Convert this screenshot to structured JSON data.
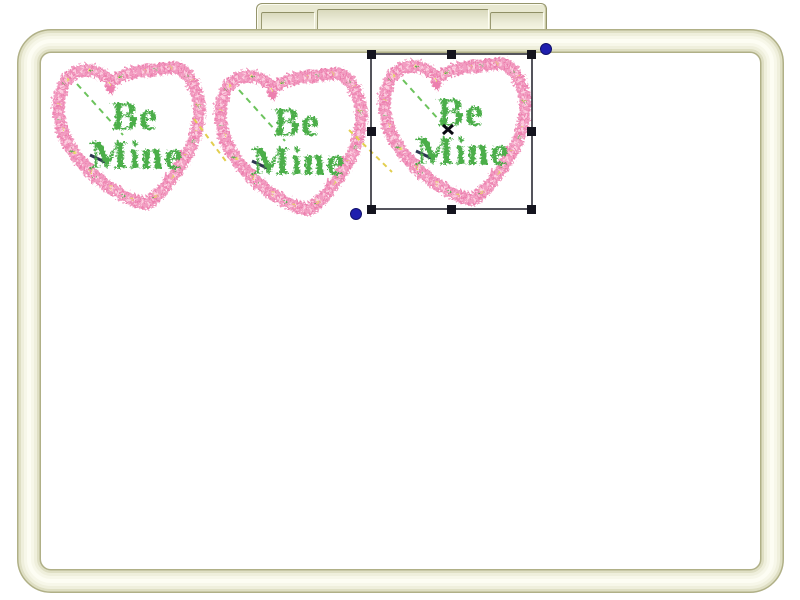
{
  "design_text": {
    "line1": "Be",
    "line2": "Mine"
  },
  "designs": [
    {
      "name": "be-mine-heart-1",
      "selected": false
    },
    {
      "name": "be-mine-heart-2",
      "selected": false
    },
    {
      "name": "be-mine-heart-3",
      "selected": true
    }
  ],
  "selection": {
    "handle_count": 8,
    "rotation_dot_count": 2,
    "center_mark": "x"
  },
  "colors": {
    "heart_stitch_pink": "#f29ec2",
    "heart_stitch_pink_dark": "#ec7fae",
    "heart_stitch_pink_light": "#fccfe0",
    "lettering_green": "#4bae49",
    "jump_stitch_green": "#6cc35c",
    "connector_yellow": "#e2ce4f",
    "tieoff_gold": "#e3da5c",
    "hoop_cream": "#efefdc",
    "hoop_edge_olive": "#b0b087",
    "selection_outline": "#2a2a33",
    "selection_handle": "#14141e",
    "rotation_dot_blue": "#1f1fae",
    "canvas_background": "#ffffff"
  }
}
